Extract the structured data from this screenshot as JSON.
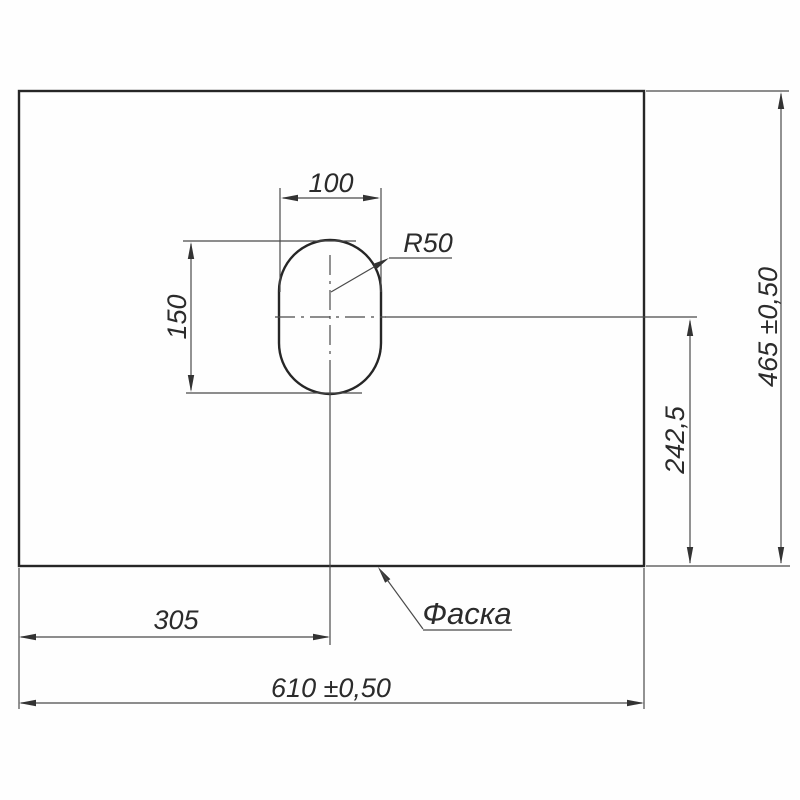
{
  "drawing": {
    "note": {
      "chamfer": "Фаска"
    },
    "dims": {
      "panel_width": "610 ±0,50",
      "panel_height": "465 ±0,50",
      "hole_offset_from_left": "305",
      "hole_center_from_bottom": "242,5",
      "hole_width": "100",
      "hole_height": "150",
      "hole_corner_radius": "R50"
    }
  }
}
